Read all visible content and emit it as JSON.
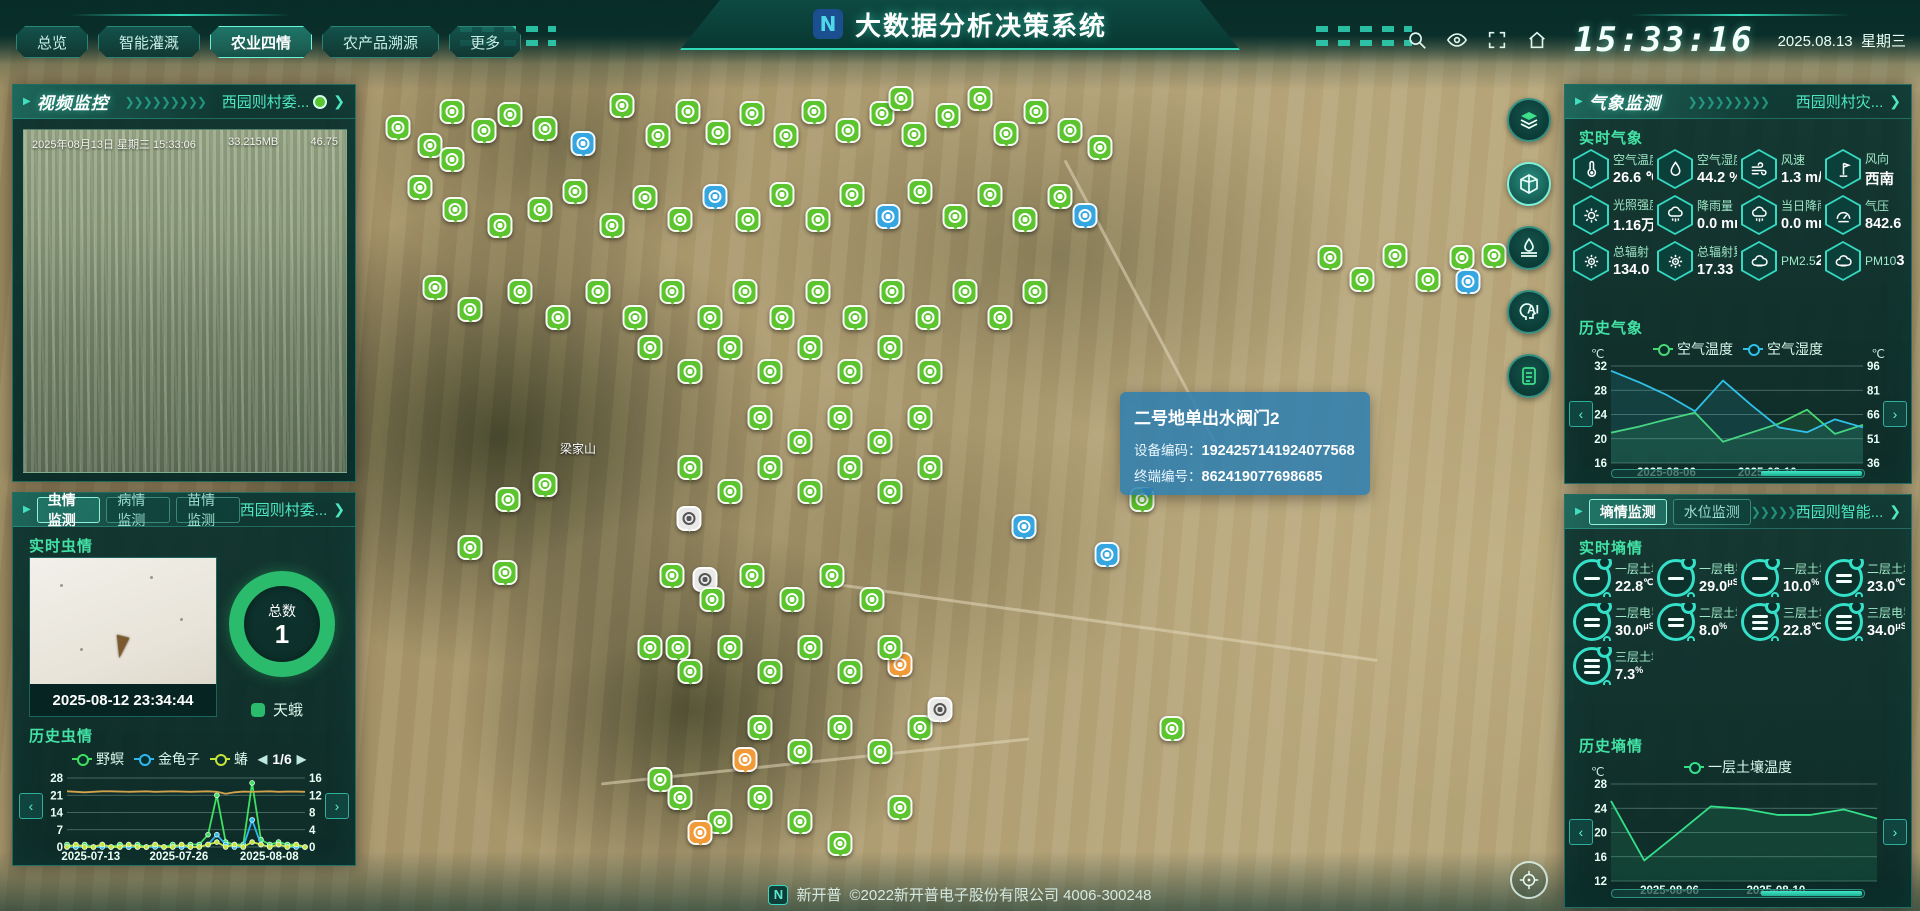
{
  "header": {
    "title": "大数据分析决策系统",
    "logo_glyph": "N",
    "nav": [
      {
        "label": "总览",
        "active": false
      },
      {
        "label": "智能灌溉",
        "active": false
      },
      {
        "label": "农业四情",
        "active": true
      },
      {
        "label": "农产品溯源",
        "active": false
      },
      {
        "label": "更多",
        "active": false
      }
    ],
    "clock": "15:33:16",
    "date": "2025.08.13",
    "weekday": "星期三"
  },
  "video_panel": {
    "title": "视频监控",
    "link": "西园则村委...",
    "overlay_datetime": "2025年08月13日 星期三 15:33:06",
    "overlay_size": "33.215MB",
    "overlay_value": "46.75"
  },
  "insect_panel": {
    "tabs": [
      "虫情监测",
      "病情监测",
      "苗情监测"
    ],
    "active_tab": 0,
    "link": "西园则村委...",
    "realtime_title": "实时虫情",
    "photo_time": "2025-08-12 23:34:44",
    "total_label": "总数",
    "total_value": "1",
    "species_label": "天蛾",
    "history_title": "历史虫情",
    "pagination": "1/6"
  },
  "map": {
    "place_label": "梁家山",
    "tooltip": {
      "title": "二号地单出水阀门2",
      "rows": [
        {
          "label": "设备编码：",
          "value": "1924257141924077568"
        },
        {
          "label": "终端编号：",
          "value": "862419077698685"
        }
      ]
    },
    "tools": [
      "layers",
      "cube-3d",
      "irrigation",
      "ai",
      "report"
    ],
    "active_tool": 1,
    "pins": [
      [
        398,
        140,
        "g"
      ],
      [
        430,
        158,
        "g"
      ],
      [
        452,
        124,
        "g"
      ],
      [
        484,
        143,
        "g"
      ],
      [
        452,
        172,
        "g"
      ],
      [
        510,
        127,
        "g"
      ],
      [
        545,
        141,
        "g"
      ],
      [
        583,
        156,
        "b"
      ],
      [
        622,
        118,
        "g"
      ],
      [
        658,
        148,
        "g"
      ],
      [
        688,
        124,
        "g"
      ],
      [
        718,
        145,
        "g"
      ],
      [
        752,
        126,
        "g"
      ],
      [
        786,
        148,
        "g"
      ],
      [
        814,
        124,
        "g"
      ],
      [
        848,
        143,
        "g"
      ],
      [
        882,
        126,
        "g"
      ],
      [
        914,
        147,
        "g"
      ],
      [
        948,
        128,
        "g"
      ],
      [
        980,
        111,
        "g"
      ],
      [
        1006,
        146,
        "g"
      ],
      [
        1036,
        124,
        "g"
      ],
      [
        1070,
        143,
        "g"
      ],
      [
        901,
        111,
        "g"
      ],
      [
        1100,
        160,
        "g"
      ],
      [
        420,
        200,
        "g"
      ],
      [
        455,
        222,
        "g"
      ],
      [
        500,
        238,
        "g"
      ],
      [
        540,
        222,
        "g"
      ],
      [
        575,
        204,
        "g"
      ],
      [
        612,
        238,
        "g"
      ],
      [
        645,
        210,
        "g"
      ],
      [
        680,
        232,
        "g"
      ],
      [
        715,
        209,
        "b"
      ],
      [
        748,
        232,
        "g"
      ],
      [
        782,
        207,
        "g"
      ],
      [
        818,
        232,
        "g"
      ],
      [
        852,
        207,
        "g"
      ],
      [
        888,
        229,
        "b"
      ],
      [
        920,
        204,
        "g"
      ],
      [
        955,
        229,
        "g"
      ],
      [
        990,
        207,
        "g"
      ],
      [
        1025,
        232,
        "g"
      ],
      [
        1060,
        209,
        "g"
      ],
      [
        1085,
        228,
        "b"
      ],
      [
        435,
        300,
        "g"
      ],
      [
        470,
        322,
        "g"
      ],
      [
        520,
        304,
        "g"
      ],
      [
        558,
        330,
        "g"
      ],
      [
        598,
        304,
        "g"
      ],
      [
        635,
        330,
        "g"
      ],
      [
        672,
        304,
        "g"
      ],
      [
        710,
        330,
        "g"
      ],
      [
        745,
        304,
        "g"
      ],
      [
        782,
        330,
        "g"
      ],
      [
        818,
        304,
        "g"
      ],
      [
        855,
        330,
        "g"
      ],
      [
        892,
        304,
        "g"
      ],
      [
        928,
        330,
        "g"
      ],
      [
        965,
        304,
        "g"
      ],
      [
        1000,
        330,
        "g"
      ],
      [
        1035,
        304,
        "g"
      ],
      [
        1330,
        270,
        "g"
      ],
      [
        1362,
        292,
        "g"
      ],
      [
        1395,
        268,
        "g"
      ],
      [
        1428,
        292,
        "g"
      ],
      [
        1462,
        270,
        "g"
      ],
      [
        1468,
        294,
        "b"
      ],
      [
        1494,
        268,
        "g"
      ],
      [
        650,
        360,
        "g"
      ],
      [
        690,
        384,
        "g"
      ],
      [
        730,
        360,
        "g"
      ],
      [
        770,
        384,
        "g"
      ],
      [
        810,
        360,
        "g"
      ],
      [
        850,
        384,
        "g"
      ],
      [
        890,
        360,
        "g"
      ],
      [
        930,
        384,
        "g"
      ],
      [
        760,
        430,
        "g"
      ],
      [
        800,
        454,
        "g"
      ],
      [
        840,
        430,
        "g"
      ],
      [
        880,
        454,
        "g"
      ],
      [
        920,
        430,
        "g"
      ],
      [
        690,
        480,
        "g"
      ],
      [
        730,
        504,
        "g"
      ],
      [
        770,
        480,
        "g"
      ],
      [
        810,
        504,
        "g"
      ],
      [
        850,
        480,
        "g"
      ],
      [
        890,
        504,
        "g"
      ],
      [
        930,
        480,
        "g"
      ],
      [
        508,
        512,
        "g"
      ],
      [
        545,
        497,
        "g"
      ],
      [
        470,
        560,
        "g"
      ],
      [
        505,
        585,
        "g"
      ],
      [
        689,
        531,
        "w"
      ],
      [
        705,
        592,
        "w"
      ],
      [
        678,
        660,
        "g"
      ],
      [
        1142,
        512,
        "g"
      ],
      [
        1024,
        539,
        "b"
      ],
      [
        1107,
        567,
        "b"
      ],
      [
        672,
        588,
        "g"
      ],
      [
        712,
        612,
        "g"
      ],
      [
        752,
        588,
        "g"
      ],
      [
        792,
        612,
        "g"
      ],
      [
        832,
        588,
        "g"
      ],
      [
        872,
        612,
        "g"
      ],
      [
        900,
        677,
        "o"
      ],
      [
        650,
        660,
        "g"
      ],
      [
        690,
        684,
        "g"
      ],
      [
        730,
        660,
        "g"
      ],
      [
        770,
        684,
        "g"
      ],
      [
        810,
        660,
        "g"
      ],
      [
        850,
        684,
        "g"
      ],
      [
        890,
        660,
        "g"
      ],
      [
        1172,
        741,
        "g"
      ],
      [
        760,
        740,
        "g"
      ],
      [
        800,
        764,
        "g"
      ],
      [
        840,
        740,
        "g"
      ],
      [
        880,
        764,
        "g"
      ],
      [
        920,
        740,
        "g"
      ],
      [
        940,
        722,
        "w"
      ],
      [
        745,
        772,
        "o"
      ],
      [
        660,
        792,
        "g"
      ],
      [
        680,
        810,
        "g"
      ],
      [
        720,
        834,
        "g"
      ],
      [
        760,
        810,
        "g"
      ],
      [
        800,
        834,
        "g"
      ],
      [
        840,
        856,
        "g"
      ],
      [
        900,
        820,
        "g"
      ],
      [
        700,
        845,
        "o"
      ]
    ]
  },
  "weather_panel": {
    "title": "气象监测",
    "link": "西园则村灾...",
    "realtime_title": "实时气象",
    "stats": [
      {
        "label": "空气温度",
        "value": "26.6 ℃",
        "icon": "thermometer-icon"
      },
      {
        "label": "空气湿度",
        "value": "44.2 %",
        "icon": "humidity-icon"
      },
      {
        "label": "风速",
        "value": "1.3 m/s",
        "icon": "wind-icon"
      },
      {
        "label": "风向",
        "value": "西南",
        "icon": "wind-vane-icon"
      },
      {
        "label": "光照强度",
        "value": "1.16万 L",
        "icon": "sunshine-icon"
      },
      {
        "label": "降雨量",
        "value": "0.0 mm",
        "icon": "rainfall-icon"
      },
      {
        "label": "当日降雨量",
        "value": "0.0 mm",
        "icon": "rainfall-icon"
      },
      {
        "label": "气压",
        "value": "842.6 hP",
        "icon": "pressure-icon"
      },
      {
        "label": "总辐射",
        "value": "134.0 w",
        "icon": "radiation-icon"
      },
      {
        "label": "总辐射累计",
        "value": "17.33 M",
        "icon": "radiation-icon"
      },
      {
        "label": "PM2.5",
        "value": "2.0 ug/m",
        "icon": "pm-icon"
      },
      {
        "label": "PM10",
        "value": "3.0 ug/m",
        "icon": "pm-icon"
      }
    ],
    "history_title": "历史气象"
  },
  "soil_panel": {
    "tabs": [
      "墒情监测",
      "水位监测"
    ],
    "active_tab": 0,
    "link": "西园则智能...",
    "realtime_title": "实时墒情",
    "stats": [
      {
        "label": "一层土壤温度",
        "value": "22.8",
        "unit": "℃",
        "bars": 1
      },
      {
        "label": "一层电导率",
        "value": "29.0",
        "unit": "μS/c",
        "bars": 1
      },
      {
        "label": "一层土壤湿度",
        "value": "10.0",
        "unit": "%",
        "bars": 1
      },
      {
        "label": "二层土壤温度",
        "value": "23.0",
        "unit": "℃",
        "bars": 2
      },
      {
        "label": "二层电导率",
        "value": "30.0",
        "unit": "μS/c",
        "bars": 2
      },
      {
        "label": "二层土壤湿度",
        "value": "8.0",
        "unit": "%",
        "bars": 2
      },
      {
        "label": "三层土壤温度",
        "value": "22.8",
        "unit": "℃",
        "bars": 3
      },
      {
        "label": "三层电导率",
        "value": "34.0",
        "unit": "μS/",
        "bars": 3
      },
      {
        "label": "三层土壤湿度",
        "value": "7.3",
        "unit": "%",
        "bars": 3
      }
    ],
    "history_title": "历史墒情"
  },
  "footer": {
    "brand": "新开普",
    "text": "©2022新开普电子股份有限公司 4006-300248",
    "logo_glyph": "N"
  },
  "chart_data": [
    {
      "mount": "insectChart",
      "name": "insect-history-chart",
      "type": "line",
      "title": "历史虫情",
      "w": 290,
      "h": 90,
      "pad": [
        26,
        26,
        16,
        5
      ],
      "ylim": [
        0,
        28
      ],
      "yticks": [
        0,
        7,
        14,
        21,
        28
      ],
      "ylim_right": [
        0,
        16
      ],
      "yticks_right": [
        0,
        4,
        8,
        12,
        16
      ],
      "x_labels": [
        "2025-07-13",
        "2025-07-26",
        "2025-08-08"
      ],
      "x_pos": [
        0.1,
        0.47,
        0.85
      ],
      "grid": true,
      "legend_position": "top",
      "series": [
        {
          "name": "野螟",
          "color": "#3fe05f",
          "marker": true,
          "values": [
            1,
            0,
            1,
            0,
            1,
            0,
            1,
            0,
            1,
            0,
            1,
            0,
            1,
            0,
            1,
            1,
            5,
            21,
            2,
            1,
            1,
            26,
            3,
            1,
            2,
            1,
            1,
            0
          ]
        },
        {
          "name": "金龟子",
          "color": "#2db8f0",
          "marker": true,
          "values": [
            0,
            0,
            0,
            0,
            0,
            0,
            0,
            0,
            0,
            0,
            0,
            0,
            0,
            0,
            0,
            0,
            1,
            5,
            1,
            0,
            0,
            11,
            1,
            0,
            1,
            0,
            0,
            0
          ]
        },
        {
          "name": "蝽",
          "color": "#c8e23c",
          "marker": true,
          "values": [
            0,
            1,
            0,
            0,
            1,
            0,
            0,
            1,
            0,
            0,
            1,
            0,
            0,
            1,
            0,
            0,
            1,
            2,
            0,
            1,
            0,
            2,
            1,
            0,
            1,
            0,
            1,
            0
          ]
        },
        {
          "name": "",
          "color": "#d2a24c",
          "marker": false,
          "values": [
            22.6,
            22.4,
            22.2,
            22.4,
            22.6,
            22.6,
            22.5,
            22.4,
            22.5,
            22.6,
            22.4,
            22.5,
            22.6,
            22.5,
            22.4,
            22.5,
            22.6,
            22.4,
            21.6,
            22.2,
            22.5,
            22.4,
            22.5,
            22.6,
            22.4,
            22.5,
            22.5,
            22.4
          ]
        }
      ]
    },
    {
      "mount": "weatherChart",
      "name": "weather-history-chart",
      "type": "line",
      "title": "历史气象",
      "unit_left": "℃",
      "unit_right": "℃",
      "w": 312,
      "h": 118,
      "pad": [
        30,
        30,
        16,
        5
      ],
      "ylim": [
        16,
        32
      ],
      "yticks": [
        16,
        20,
        24,
        28,
        32
      ],
      "ylim_right": [
        36,
        96
      ],
      "yticks_right": [
        36,
        51,
        66,
        81,
        96
      ],
      "x_labels": [
        "2025-08-06",
        "2025-08-10"
      ],
      "x_pos": [
        0.22,
        0.62
      ],
      "grid": true,
      "legend_position": "top",
      "series": [
        {
          "name": "空气温度",
          "color": "#49d974",
          "fill": true,
          "values": [
            21.0,
            22.0,
            23.2,
            24.3,
            19.5,
            21.0,
            22.5,
            24.8,
            20.8,
            22.3
          ]
        },
        {
          "name": "空气湿度",
          "color": "#2fc1e8",
          "axis": "right",
          "fill": true,
          "values": [
            93,
            86,
            78,
            68,
            87,
            72,
            58,
            55,
            63,
            58
          ]
        }
      ]
    },
    {
      "mount": "soilChart",
      "name": "soil-history-chart",
      "type": "line",
      "title": "历史墒情",
      "unit_left": "℃",
      "w": 312,
      "h": 118,
      "pad": [
        30,
        16,
        16,
        5
      ],
      "ylim": [
        12,
        28
      ],
      "yticks": [
        12,
        16,
        20,
        24,
        28
      ],
      "x_labels": [
        "2025-08-06",
        "2025-08-10"
      ],
      "x_pos": [
        0.22,
        0.62
      ],
      "grid": true,
      "legend_position": "top",
      "series": [
        {
          "name": "一层土壤温度",
          "color": "#35e08a",
          "fill": true,
          "values": [
            25.2,
            15.4,
            19.8,
            24.3,
            23.9,
            22.9,
            22.9,
            23.8,
            22.3
          ]
        }
      ]
    }
  ]
}
